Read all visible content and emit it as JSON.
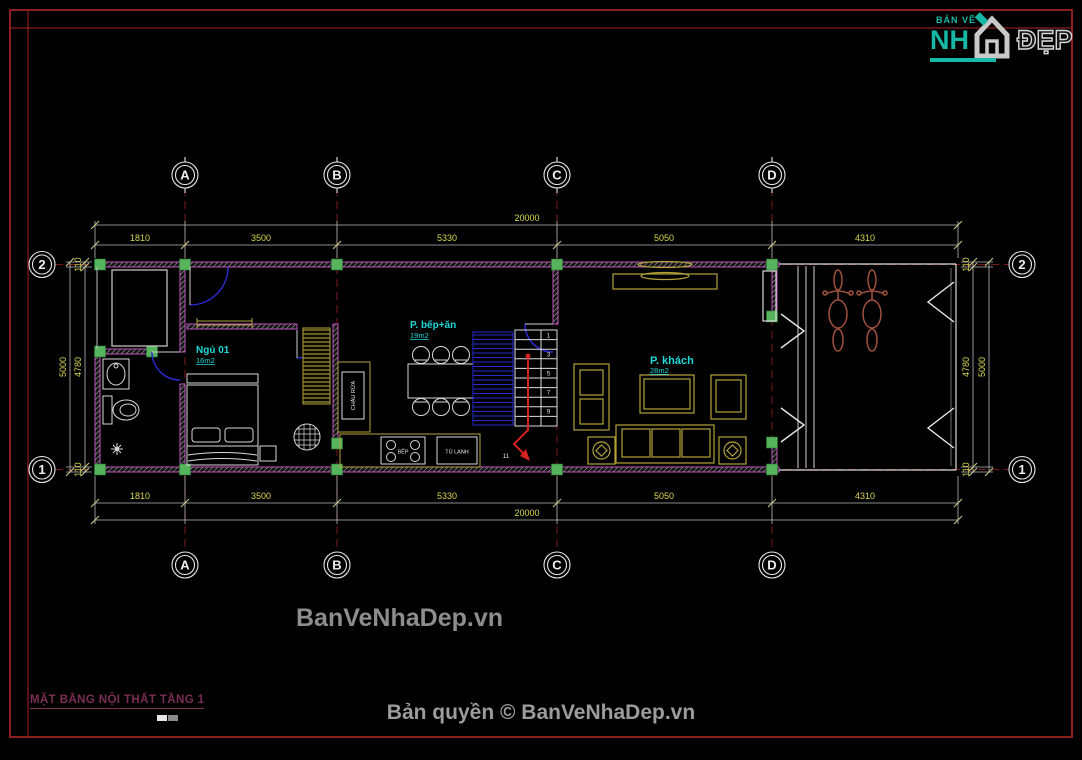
{
  "title_block": {
    "drawing_title": "MẶT BẰNG NỘI THẤT TẦNG 1"
  },
  "watermark": "BanVeNhaDep.vn",
  "footer": {
    "copyright": "Bản quyền © BanVeNhaDep.vn"
  },
  "logo": {
    "small": "BẢN VẼ",
    "big_left": "NH",
    "big_right": "ĐẸP"
  },
  "axes": {
    "cols": [
      "A",
      "B",
      "C",
      "D"
    ],
    "row_top": "2",
    "row_bottom": "1"
  },
  "dims": {
    "top": {
      "segments": [
        "1810",
        "3500",
        "5330",
        "5050",
        "4310"
      ],
      "total": "20000"
    },
    "bottom": {
      "segments": [
        "1810",
        "3500",
        "5330",
        "5050",
        "4310"
      ],
      "total": "20000"
    },
    "left": {
      "segments": [
        "110",
        "4780",
        "110"
      ],
      "total": "5000"
    },
    "right": {
      "segments": [
        "110",
        "4780",
        "110"
      ],
      "total": "5000"
    }
  },
  "rooms": {
    "bedroom": {
      "name": "Ngủ 01",
      "area": "16m2"
    },
    "kitchen": {
      "name": "P. bếp+ăn",
      "area": "19m2"
    },
    "living": {
      "name": "P. khách",
      "area": "28m2"
    }
  },
  "fixtures": {
    "sink": "CHẬU RỬA",
    "stove": "BẾP",
    "fridge": "TỦ LẠNH"
  },
  "stairs": {
    "numbers": [
      "1",
      "3",
      "5",
      "7",
      "9",
      "11"
    ]
  },
  "colors": {
    "wall": "#c155c1",
    "column": "#56b45c",
    "dim_text": "#d8d855",
    "axis_line": "#7a1818",
    "room_label": "#1fd9d9",
    "furniture": "#b2a23b",
    "door": "#2a2ad0",
    "stair_arrow": "#d22222",
    "bike": "#a0523d",
    "frame": "#8b1f1f",
    "logo_teal": "#17b8a6"
  }
}
